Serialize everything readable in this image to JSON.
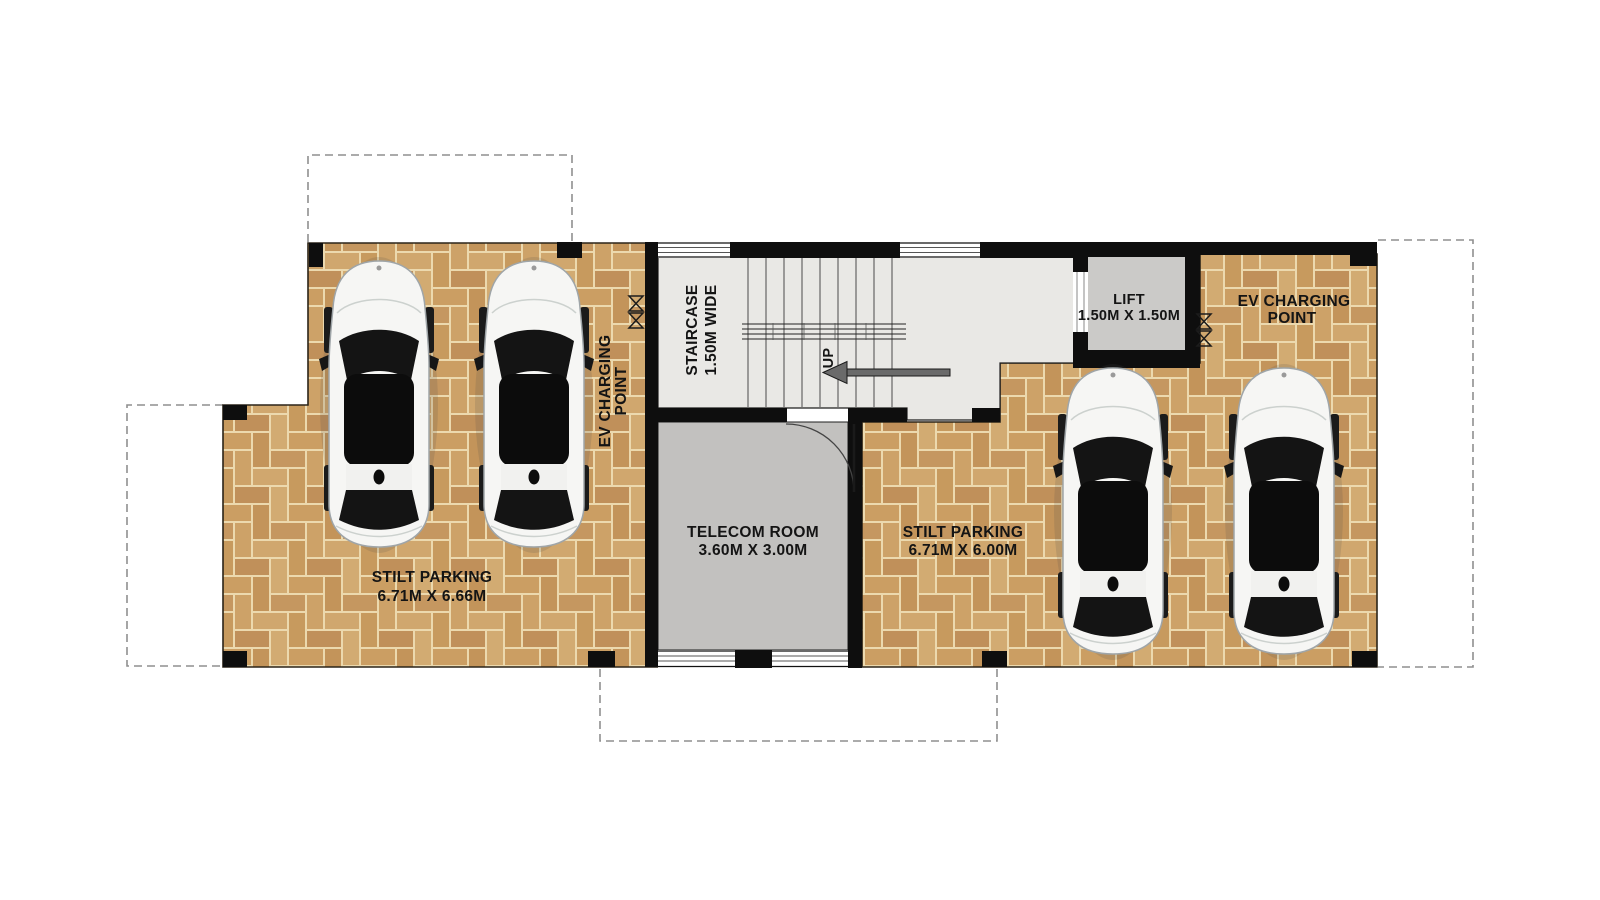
{
  "labels": {
    "staircase": {
      "line1": "STAIRCASE",
      "line2": "1.50M WIDE"
    },
    "up": "UP",
    "lift": {
      "line1": "LIFT",
      "line2": "1.50M X 1.50M"
    },
    "telecom": {
      "line1": "TELECOM ROOM",
      "line2": "3.60M X 3.00M"
    },
    "parking_left": {
      "line1": "STILT PARKING",
      "line2": "6.71M X 6.66M"
    },
    "parking_right": {
      "line1": "STILT PARKING",
      "line2": "6.71M X 6.00M"
    },
    "ev_left": {
      "line1": "EV CHARGING",
      "line2": "POINT"
    },
    "ev_right": {
      "line1": "EV CHARGING",
      "line2": "POINT"
    }
  },
  "colors": {
    "wall": "#0e0e0e",
    "brick": "#c89c62",
    "mortar": "#ecd9ae",
    "stair_floor": "#e9e8e5",
    "telecom_floor": "#c2c1bf",
    "lift_floor": "#cbcac8",
    "car_body": "#f6f6f4",
    "boundary_dash": "#8f8f8f",
    "text": "#141414"
  }
}
